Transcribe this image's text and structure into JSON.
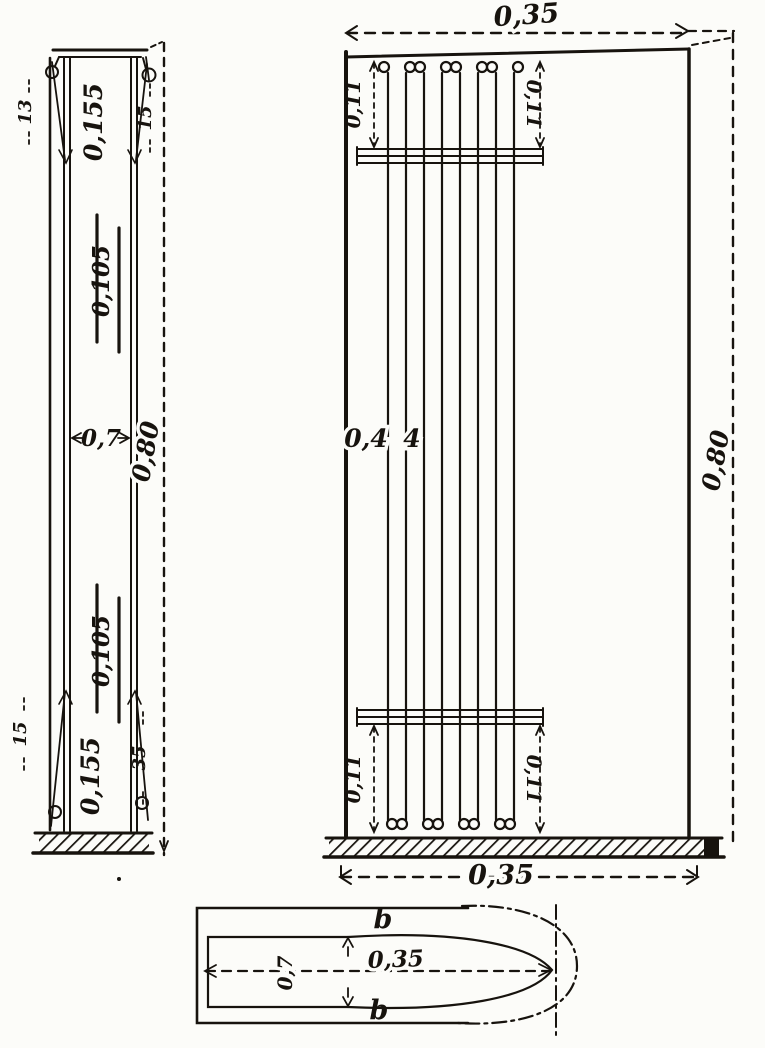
{
  "colors": {
    "paper": "#fcfcf9",
    "ink": "#17130e"
  },
  "side_view": {
    "dim_top_block": "0,155",
    "dim_upper": "0,105",
    "dim_width": "0,7",
    "dim_lower": "0,105",
    "dim_bottom_block": "0,155",
    "dim_height": "0,80",
    "tick_top_left": "13",
    "tick_top_right": "15",
    "tick_bottom_left": "15",
    "tick_bottom_right": "35"
  },
  "front_view": {
    "string_count": 8,
    "dim_top_width": "0,35",
    "dim_bottom_width": "0,35",
    "dim_height": "0,80",
    "offset_top_left": "0,11",
    "offset_top_right": "0,11",
    "offset_bottom_left": "0,11",
    "offset_bottom_right": "0,11",
    "string_length_a": "0,4",
    "string_length_b": "4"
  },
  "plan_view": {
    "dim_length": "0,35",
    "dim_width": "0,7",
    "label_top": "b",
    "label_bottom": "b"
  }
}
